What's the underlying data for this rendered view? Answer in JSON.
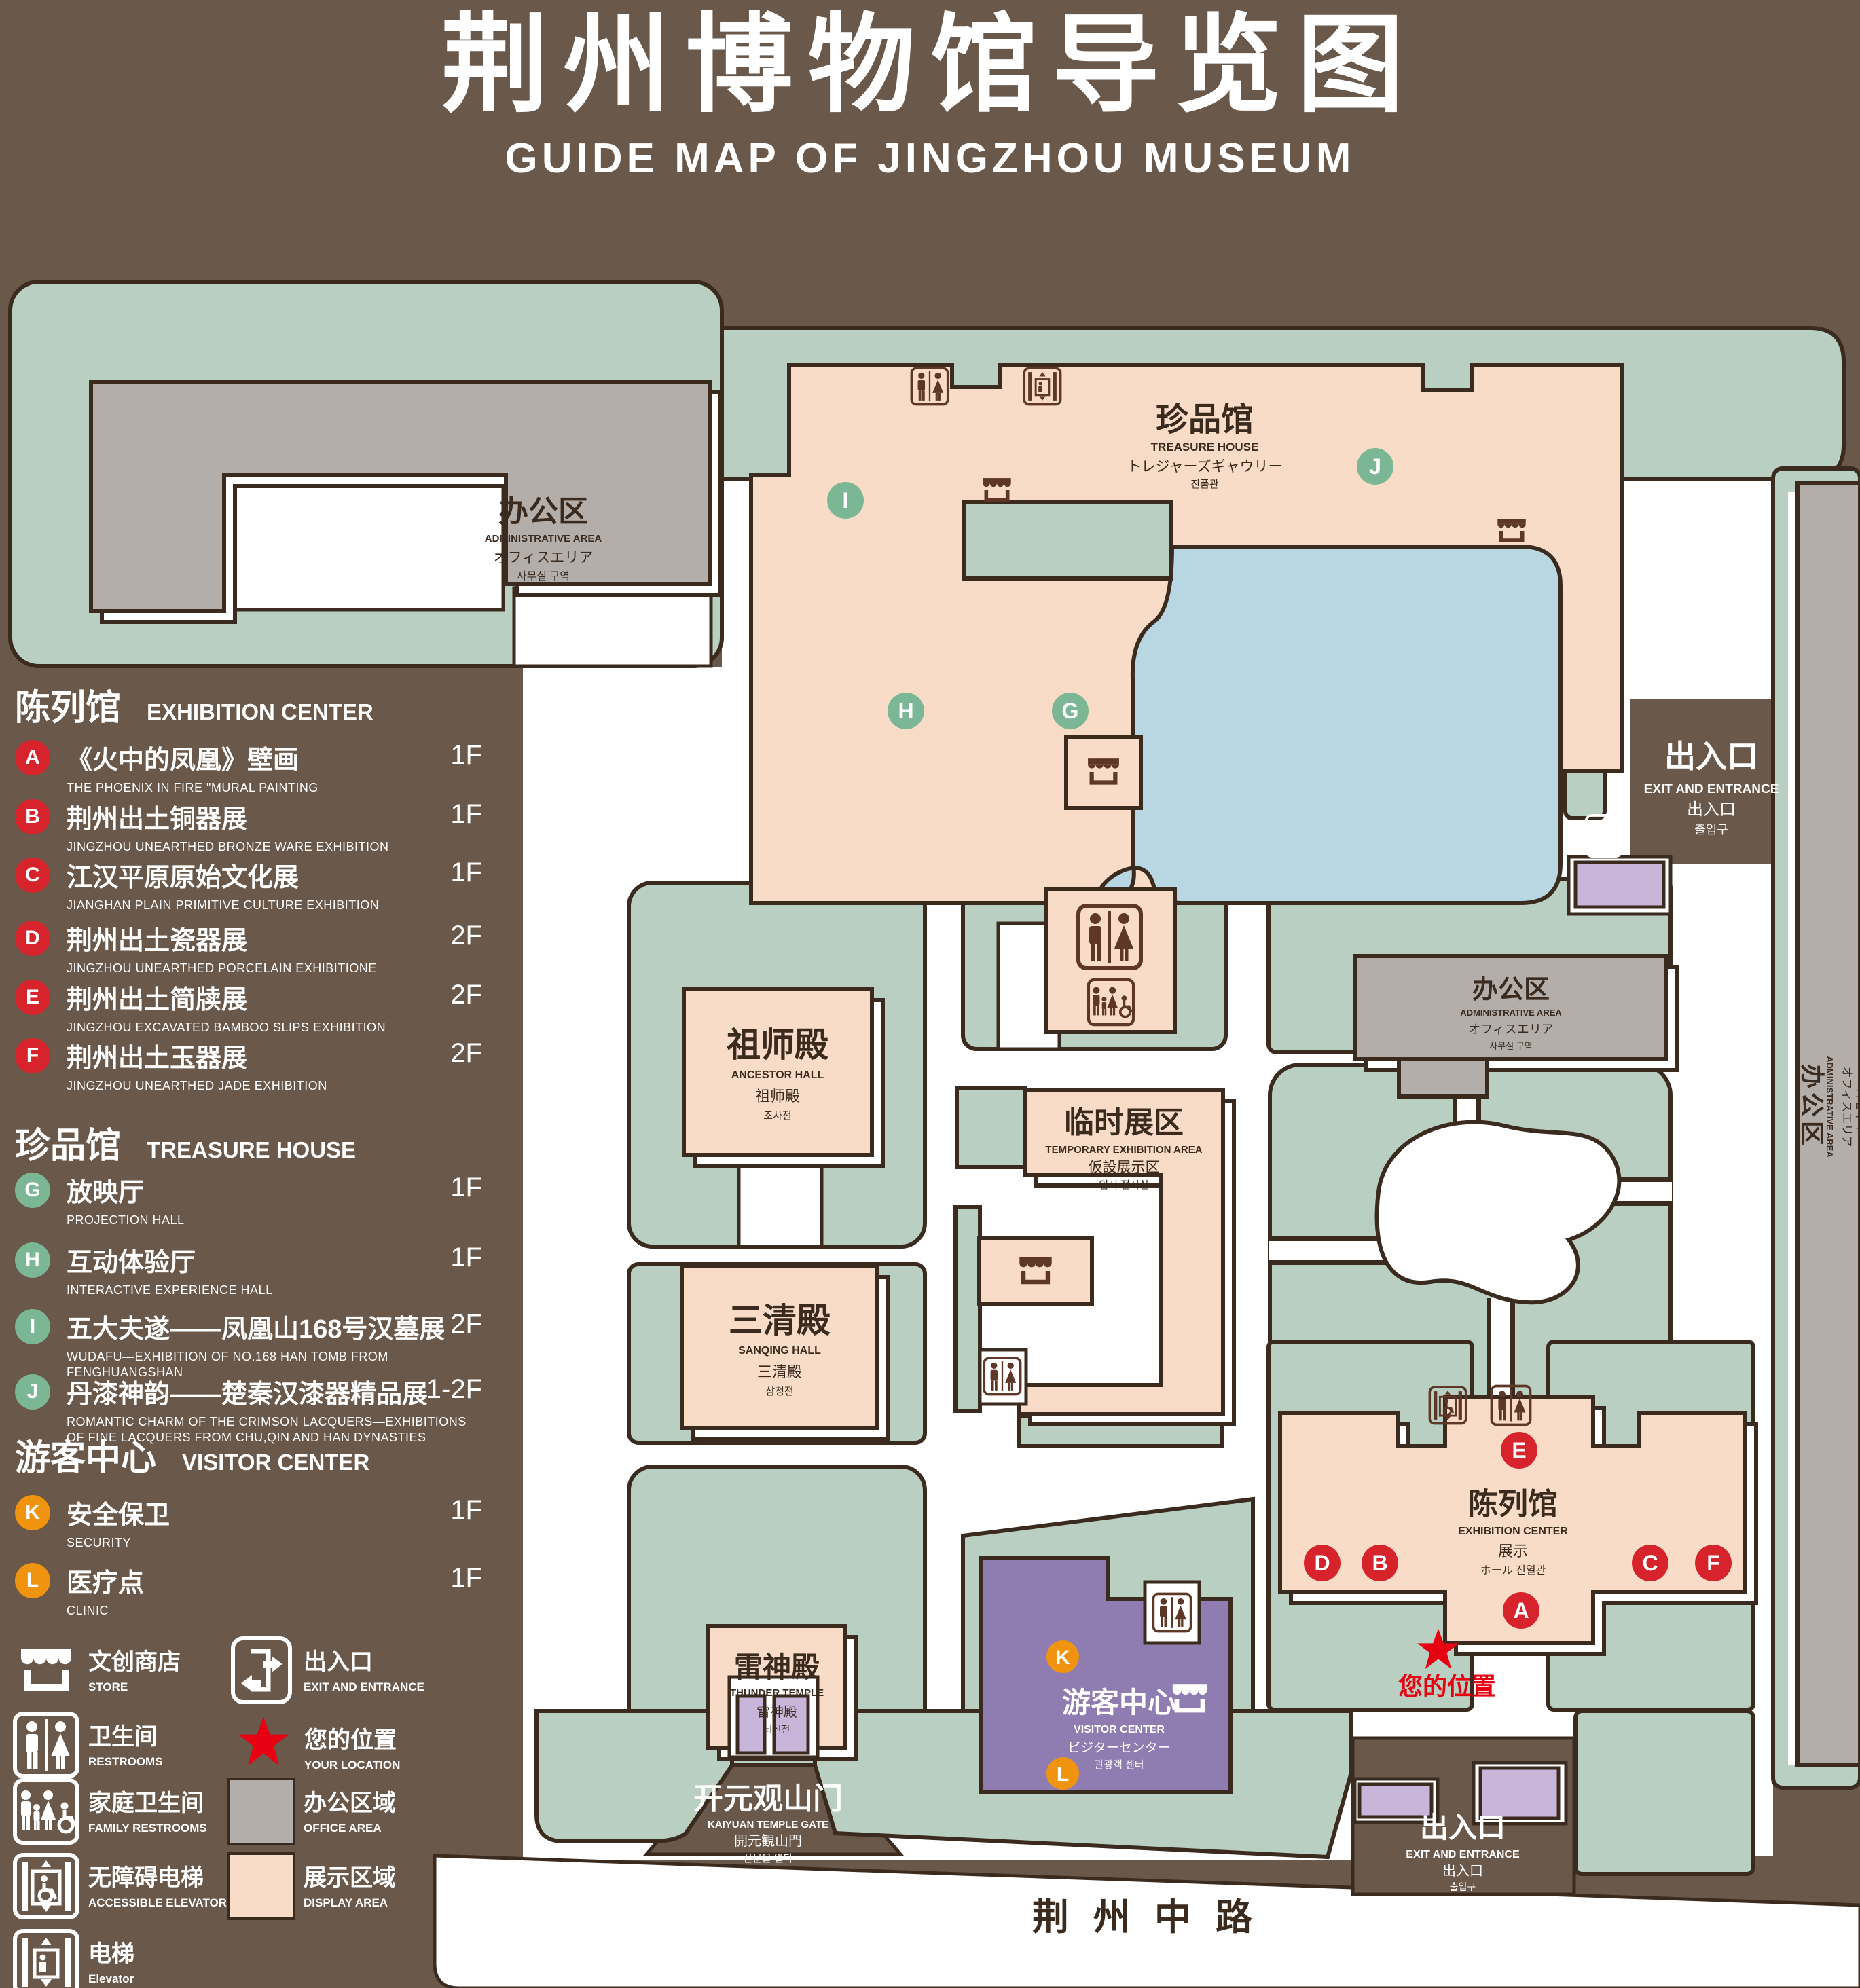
{
  "title": {
    "zh": "荆州博物馆导览图",
    "en": "GUIDE MAP OF JINGZHOU MUSEUM"
  },
  "colors": {
    "background": "#6a584a",
    "line": "#3b2b1f",
    "green_area": "#b9cfc1",
    "display_area": "#f8dcc8",
    "office_area": "#b3aeaa",
    "water": "#b9d7e3",
    "visitor_purple": "#8f7cb0",
    "gate_purple": "#c7b6d9",
    "badge_red": "#d7232b",
    "badge_green": "#7cb795",
    "badge_orange": "#f0930f",
    "location_red": "#e60012",
    "icon_brown": "#5e3726"
  },
  "legend": {
    "sections": [
      {
        "zh": "陈列馆",
        "en": "EXHIBITION CENTER",
        "items": [
          {
            "id": "A",
            "zh": "《火中的凤凰》壁画",
            "en": "THE PHOENIX IN FIRE \"MURAL PAINTING",
            "floor": "1F"
          },
          {
            "id": "B",
            "zh": "荆州出土铜器展",
            "en": "JINGZHOU UNEARTHED BRONZE WARE EXHIBITION",
            "floor": "1F"
          },
          {
            "id": "C",
            "zh": "江汉平原原始文化展",
            "en": "JIANGHAN PLAIN PRIMITIVE CULTURE EXHIBITION",
            "floor": "1F"
          },
          {
            "id": "D",
            "zh": "荆州出土瓷器展",
            "en": "JINGZHOU UNEARTHED PORCELAIN EXHIBITIONE",
            "floor": "2F"
          },
          {
            "id": "E",
            "zh": "荆州出土简牍展",
            "en": "JINGZHOU EXCAVATED BAMBOO SLIPS EXHIBITION",
            "floor": "2F"
          },
          {
            "id": "F",
            "zh": "荆州出土玉器展",
            "en": "JINGZHOU UNEARTHED JADE EXHIBITION",
            "floor": "2F"
          }
        ]
      },
      {
        "zh": "珍品馆",
        "en": "TREASURE HOUSE",
        "items": [
          {
            "id": "G",
            "zh": "放映厅",
            "en": "PROJECTION HALL",
            "floor": "1F"
          },
          {
            "id": "H",
            "zh": "互动体验厅",
            "en": "INTERACTIVE EXPERIENCE HALL",
            "floor": "1F"
          },
          {
            "id": "I",
            "zh": "五大夫遂——凤凰山168号汉墓展",
            "en": "WUDAFU—EXHIBITION OF NO.168 HAN TOMB FROM FENGHUANGSHAN",
            "floor": "2F"
          },
          {
            "id": "J",
            "zh": "丹漆神韵——楚秦汉漆器精品展",
            "en": "ROMANTIC CHARM OF THE CRIMSON LACQUERS—EXHIBITIONS OF FINE LACQUERS FROM CHU,QIN AND HAN DYNASTIES",
            "floor": "1-2F"
          }
        ]
      },
      {
        "zh": "游客中心",
        "en": "VISITOR CENTER",
        "items": [
          {
            "id": "K",
            "zh": "安全保卫",
            "en": "SECURITY",
            "floor": "1F"
          },
          {
            "id": "L",
            "zh": "医疗点",
            "en": "CLINIC",
            "floor": "1F"
          }
        ]
      }
    ],
    "symbols": [
      {
        "icon": "store-icon",
        "zh": "文创商店",
        "en": "STORE"
      },
      {
        "icon": "exit-icon",
        "zh": "出入口",
        "en": "EXIT AND ENTRANCE"
      },
      {
        "icon": "restroom-icon",
        "zh": "卫生间",
        "en": "RESTROOMS"
      },
      {
        "icon": "location-star-icon",
        "zh": "您的位置",
        "en": "YOUR LOCATION"
      },
      {
        "icon": "family-restroom-icon",
        "zh": "家庭卫生间",
        "en": "FAMILY RESTROOMS"
      },
      {
        "icon": "office-area-swatch",
        "zh": "办公区域",
        "en": "OFFICE AREA"
      },
      {
        "icon": "accessible-elevator-icon",
        "zh": "无障碍电梯",
        "en": "ACCESSIBLE ELEVATOR"
      },
      {
        "icon": "display-area-swatch",
        "zh": "展示区域",
        "en": "DISPLAY AREA"
      },
      {
        "icon": "elevator-icon",
        "zh": "电梯",
        "en": "Elevator"
      }
    ]
  },
  "map": {
    "road": "荆州中路",
    "your_location": "您的位置",
    "admin": {
      "zh": "办公区",
      "en": "ADMINISTRATIVE AREA",
      "ja": "オフィスエリア",
      "ko": "사무실 구역"
    },
    "treasure_house": {
      "zh": "珍品馆",
      "en": "TREASURE HOUSE",
      "ja": "トレジャーズギャウリー",
      "ko": "진품관"
    },
    "ancestor_hall": {
      "zh": "祖师殿",
      "en": "ANCESTOR HALL",
      "ja": "祖师殿",
      "ko": "조사전"
    },
    "sanqing_hall": {
      "zh": "三清殿",
      "en": "SANQING HALL",
      "ja": "三清殿",
      "ko": "삼청전"
    },
    "thunder_temple": {
      "zh": "雷神殿",
      "en": "THUNDER TEMPLE",
      "ja": "雷神殿",
      "ko": "뇌신전"
    },
    "temporary_area": {
      "zh": "临时展区",
      "en": "TEMPORARY EXHIBITION AREA",
      "ja": "仮設展示区",
      "ko": "임시 전시실"
    },
    "visitor_center": {
      "zh": "游客中心",
      "en": "VISITOR CENTER",
      "ja": "ビジターセンター",
      "ko": "관광객 센터"
    },
    "exhibition_center": {
      "zh": "陈列馆",
      "en": "EXHIBITION CENTER",
      "ja": "展示",
      "ko": "ホール 진열관"
    },
    "kaiyuan_gate": {
      "zh": "开元观山门",
      "en": "KAIYUAN TEMPLE GATE",
      "ja": "開元観山門",
      "ko": "산문을 열다"
    },
    "exit": {
      "zh": "出入口",
      "en": "EXIT AND ENTRANCE",
      "ja": "出入口",
      "ko": "출입구"
    }
  }
}
